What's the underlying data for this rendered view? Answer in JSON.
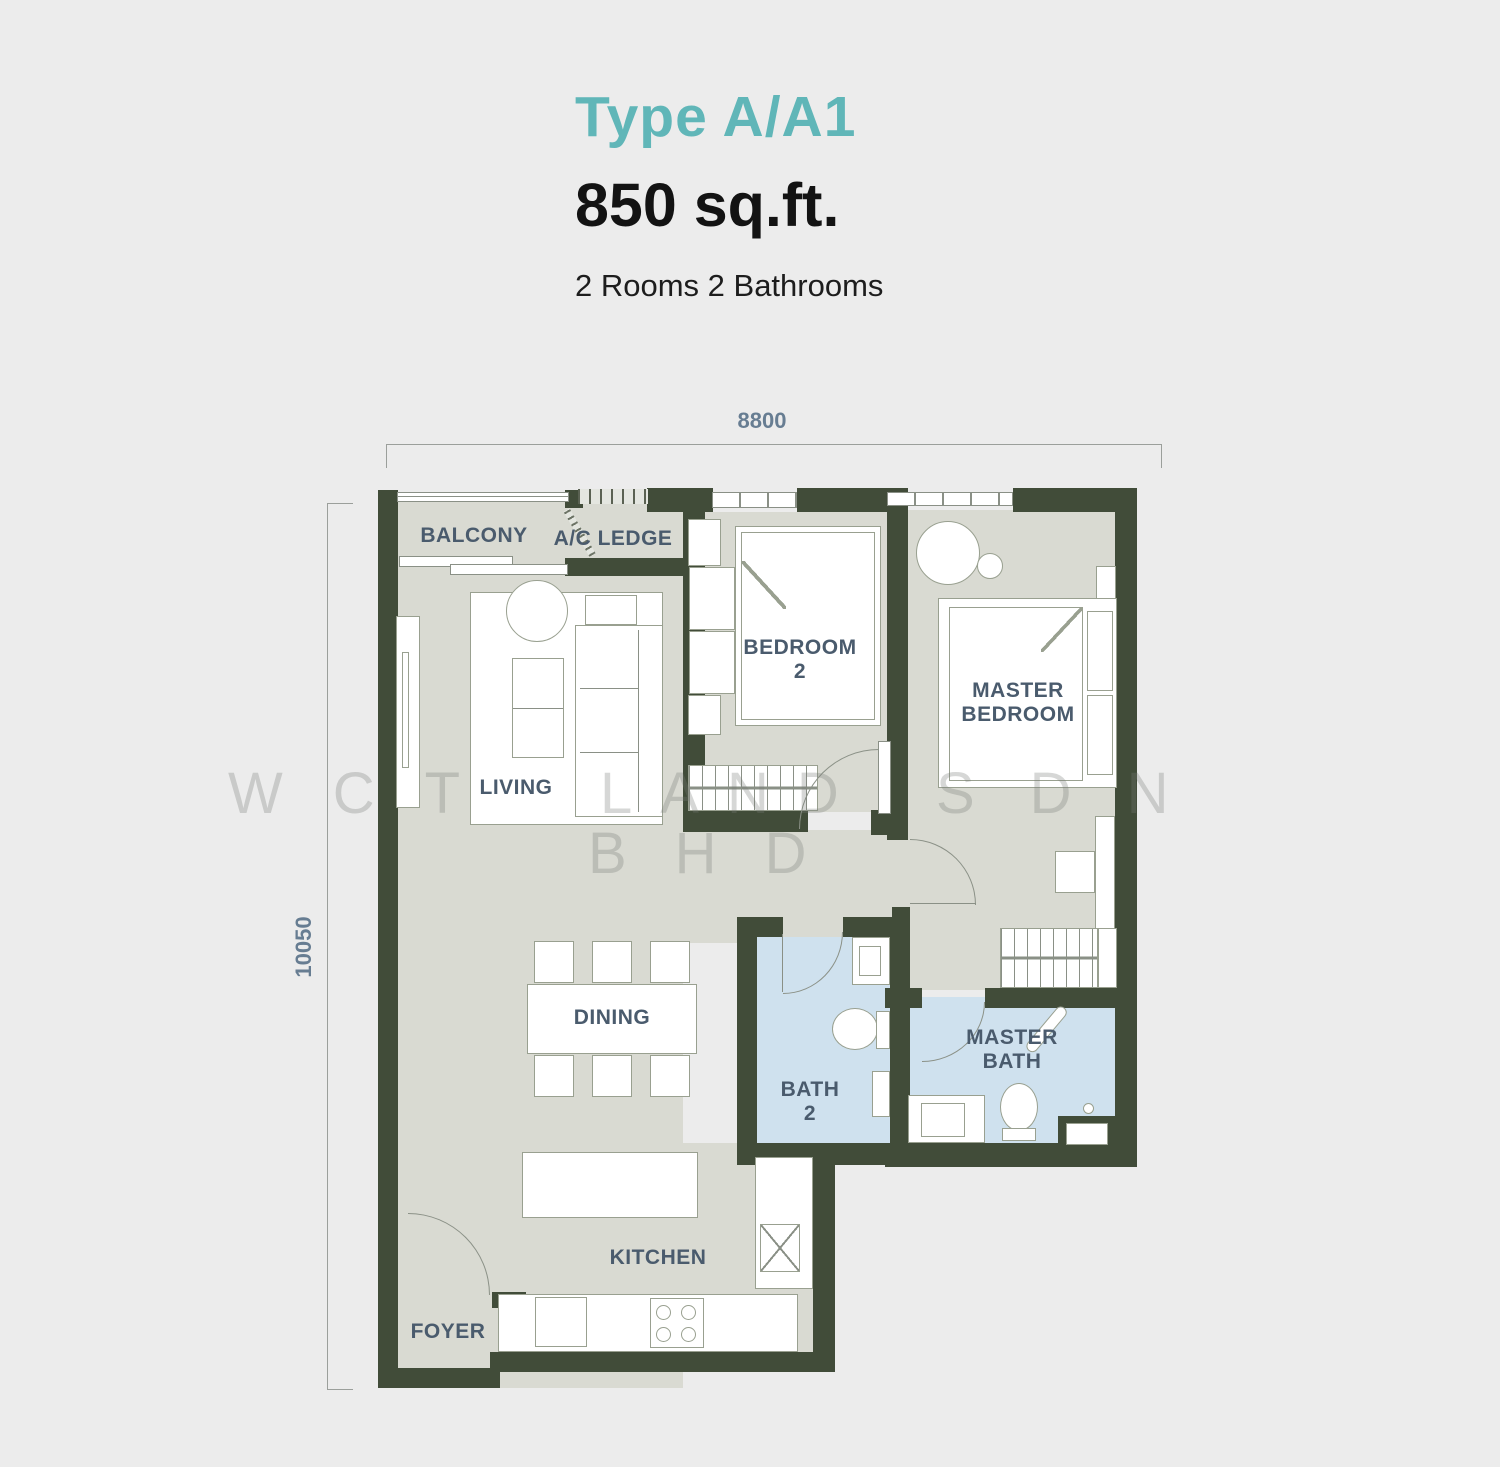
{
  "header": {
    "type_title": "Type A/A1",
    "area": "850 sq.ft.",
    "config": "2 Rooms 2 Bathrooms"
  },
  "dimensions": {
    "top": "8800",
    "left": "10050"
  },
  "room_labels": {
    "balcony": "BALCONY",
    "ac_ledge": "A/C LEDGE",
    "bedroom2_line1": "BEDROOM",
    "bedroom2_line2": "2",
    "master_bedroom_line1": "MASTER",
    "master_bedroom_line2": "BEDROOM",
    "living": "LIVING",
    "dining": "DINING",
    "bath2_line1": "BATH",
    "bath2_line2": "2",
    "master_bath_line1": "MASTER",
    "master_bath_line2": "BATH",
    "kitchen": "KITCHEN",
    "foyer": "FOYER"
  },
  "watermark": {
    "group1": "WCT",
    "group2": "LAND",
    "group3": "SDN",
    "group4": "BHD"
  },
  "colors": {
    "accent_teal": "#60b6b8",
    "wall": "#414c39",
    "floor": "#d9dad2",
    "bath_floor": "#cfe1ee",
    "label": "#4a5b6d",
    "dimension": "#677d92"
  }
}
